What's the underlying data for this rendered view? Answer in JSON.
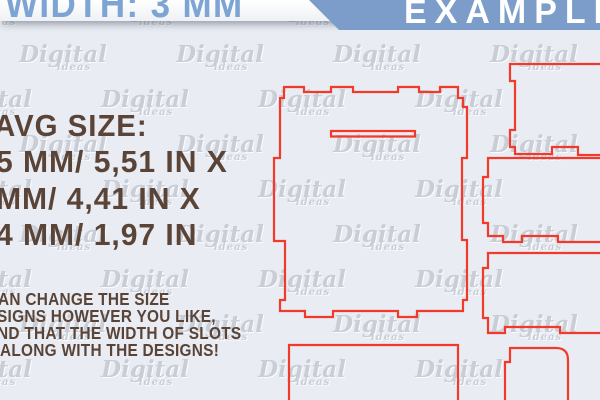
{
  "colors": {
    "background": "#e9edf3",
    "ribbon_white": "#ffffff",
    "banner_blue": "#7c9dc9",
    "banner_text_white": "#ffffff",
    "width_text_blue": "#7da4d2",
    "info_text_brown": "#5a4437",
    "cut_line_red": "#f23a2c",
    "watermark_gray": "#c2c6cf"
  },
  "header": {
    "width_label": "WIDTH: 3 MM",
    "example_label": "EXAMPLE"
  },
  "size_info": {
    "title": "AVG SIZE:",
    "lines": [
      "5 MM/ 5,51 IN X",
      "MM/ 4,41 IN X",
      "4 MM/ 1,97 IN"
    ]
  },
  "note": {
    "lines": [
      "AN CHANGE THE SIZE",
      "SIGNS HOWEVER YOU LIKE,",
      "ND THAT THE WIDTH OF SLOTS",
      "ALONG WITH THE DESIGNS!"
    ]
  },
  "watermark": {
    "word": "Digital",
    "sub": "ideas"
  }
}
